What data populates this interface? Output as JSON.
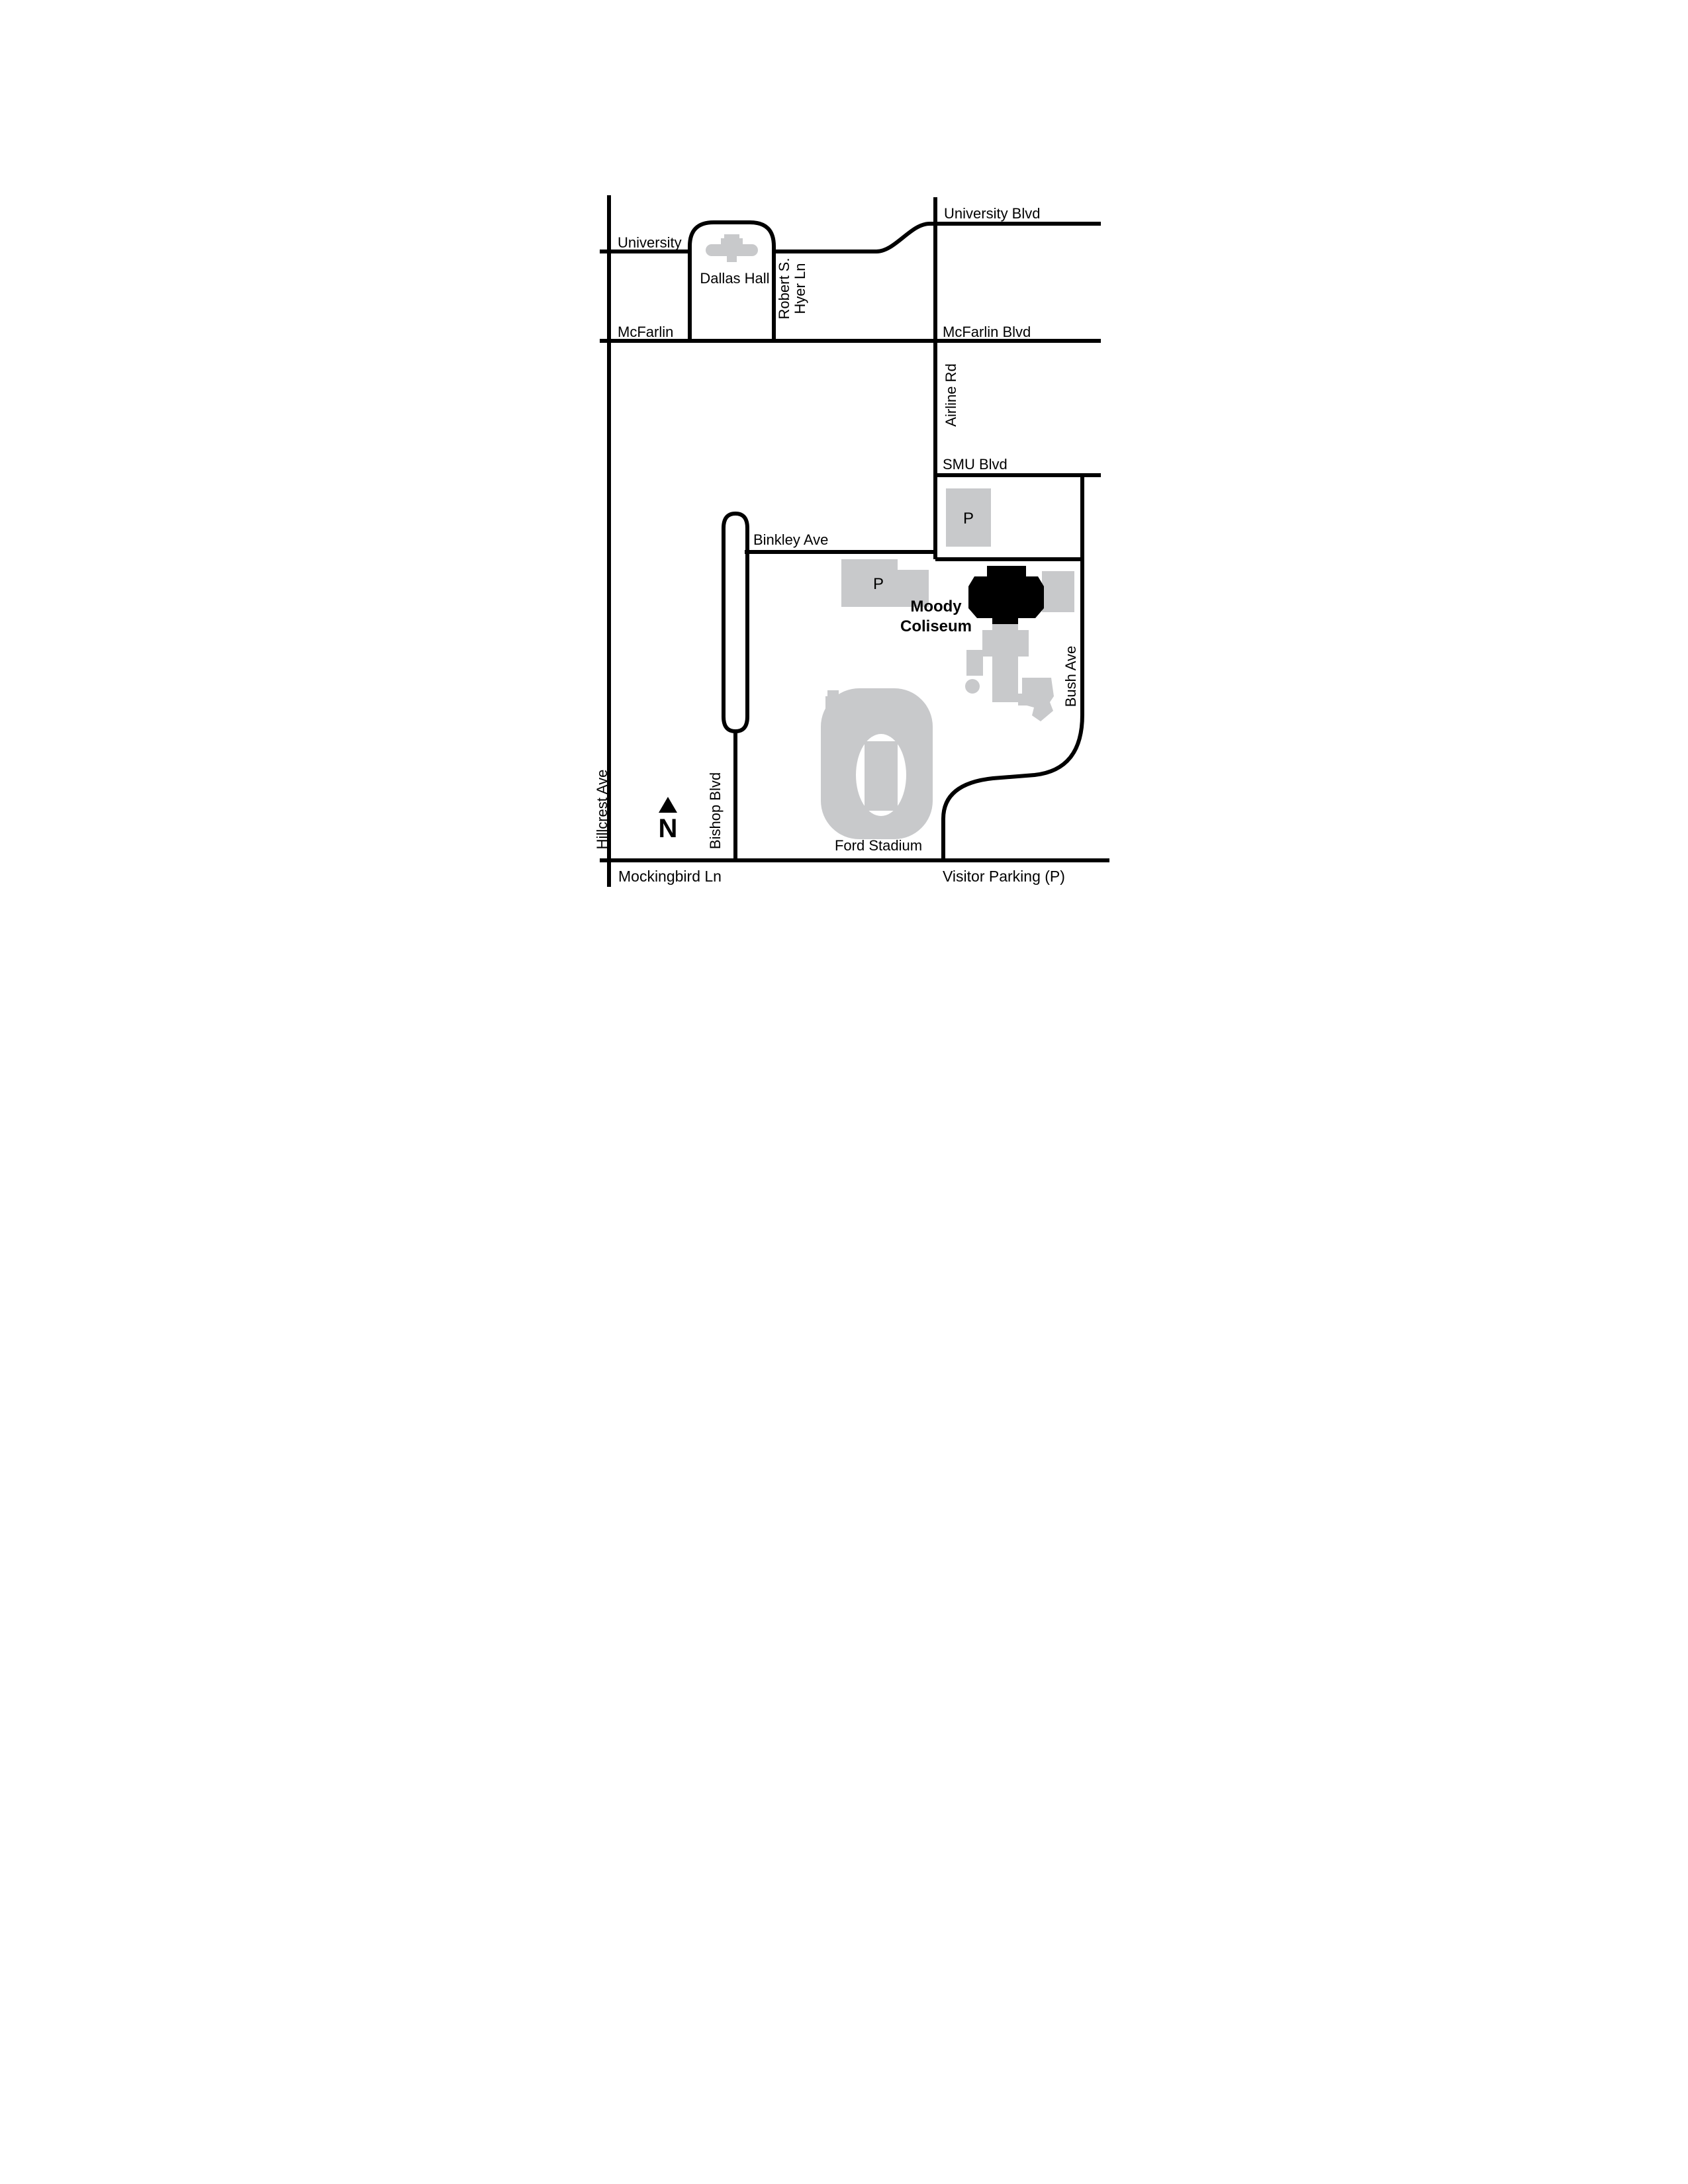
{
  "colors": {
    "road": "#000000",
    "building": "#c8c9cb",
    "coliseum": "#000000",
    "text": "#000000",
    "background": "#ffffff"
  },
  "labels": {
    "university_blvd": "University Blvd",
    "university": "University",
    "dallas_hall": "Dallas Hall",
    "robert_s": "Robert S.",
    "hyer_ln": "Hyer Ln",
    "mcfarlin": "McFarlin",
    "mcfarlin_blvd": "McFarlin Blvd",
    "airline_rd": "Airline Rd",
    "smu_blvd": "SMU Blvd",
    "binkley_ave": "Binkley Ave",
    "parking_p": "P",
    "moody_line1": "Moody",
    "moody_line2": "Coliseum",
    "bush_ave": "Bush Ave",
    "bishop_blvd": "Bishop Blvd",
    "hillcrest_ave": "Hillcrest Ave",
    "ford_stadium": "Ford Stadium",
    "mockingbird_ln": "Mockingbird Ln",
    "visitor_parking": "Visitor Parking (P)",
    "north": "N"
  }
}
